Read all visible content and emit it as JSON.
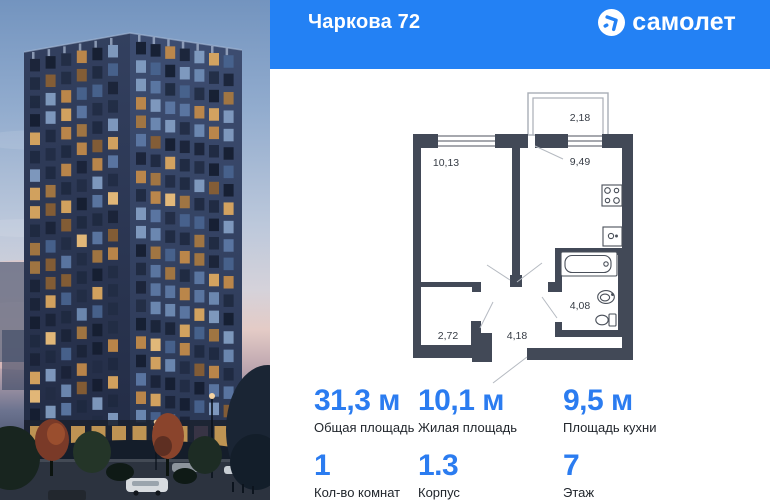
{
  "header": {
    "title": "Чаркова 72",
    "brand": "самолет",
    "logo_icon": "arrow-circle-icon"
  },
  "colors": {
    "header_bg": "#2381f4",
    "accent_numbers": "#2b7cf0",
    "plan_walls": "#424957"
  },
  "floor_plan": {
    "areas": {
      "balcony": "2,18",
      "room": "10,13",
      "kitchen": "9,49",
      "wardrobe": "2,72",
      "hall": "4,18",
      "bathroom": "4,08"
    },
    "fixtures": [
      "stove-icon",
      "kitchen-sink-icon",
      "bathtub-icon",
      "washbasin-icon",
      "toilet-icon"
    ]
  },
  "stats": {
    "row1": [
      {
        "value": "31,3 м",
        "label": "Общая площадь"
      },
      {
        "value": "10,1 м",
        "label": "Жилая площадь"
      },
      {
        "value": "9,5 м",
        "label": "Площадь кухни"
      }
    ],
    "row2": [
      {
        "value": "1",
        "label": "Кол-во комнат"
      },
      {
        "value": "1.3",
        "label": "Корпус"
      },
      {
        "value": "7",
        "label": "Этаж"
      }
    ]
  },
  "photo": {
    "alt": "Жилая башня в сумерках с подсвеченными окнами, деревьями и улицей"
  }
}
